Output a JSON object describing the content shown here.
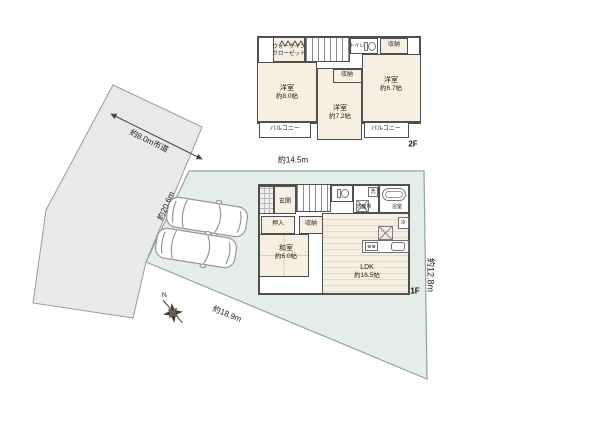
{
  "colors": {
    "road_fill": "#e9e9ec",
    "road_stroke": "#9a9aa0",
    "site_fill": "#e4ede7",
    "site_stroke": "#8aa79a",
    "room_fill": "#f7f0e2",
    "wall": "#4f4f4f",
    "car_stroke": "#98989c",
    "compass_color": "#4a3b30"
  },
  "site": {
    "road_dim": "約8.0m市道",
    "left_dim": "約20.6m",
    "top_dim": "約14.5m",
    "right_dim": "約12.8m",
    "bottom_dim": "約18.9m",
    "compass_north": "N"
  },
  "floor2": {
    "floor_label": "2F",
    "walkin_closet_line1": "ウォークイン",
    "walkin_closet_line2": "クローゼット",
    "toilet": "トイレ",
    "storage_top": "収納",
    "storage_mid": "収納",
    "bedroom_left_name": "洋室",
    "bedroom_left_size": "約8.0帖",
    "bedroom_mid_name": "洋室",
    "bedroom_mid_size": "約7.2帖",
    "bedroom_right_name": "洋室",
    "bedroom_right_size": "約6.7帖",
    "balcony_left": "バルコニー",
    "balcony_right": "バルコニー"
  },
  "floor1": {
    "floor_label": "1F",
    "entrance": "玄関",
    "closet_oshiire": "押入",
    "storage": "収納",
    "japanese_room_name": "和室",
    "japanese_room_size": "約6.0帖",
    "ldk_name": "LDK",
    "ldk_size": "約16.5帖",
    "washroom": "洗面所",
    "washer": "洗",
    "bathroom": "浴室",
    "fridge": "冷"
  }
}
